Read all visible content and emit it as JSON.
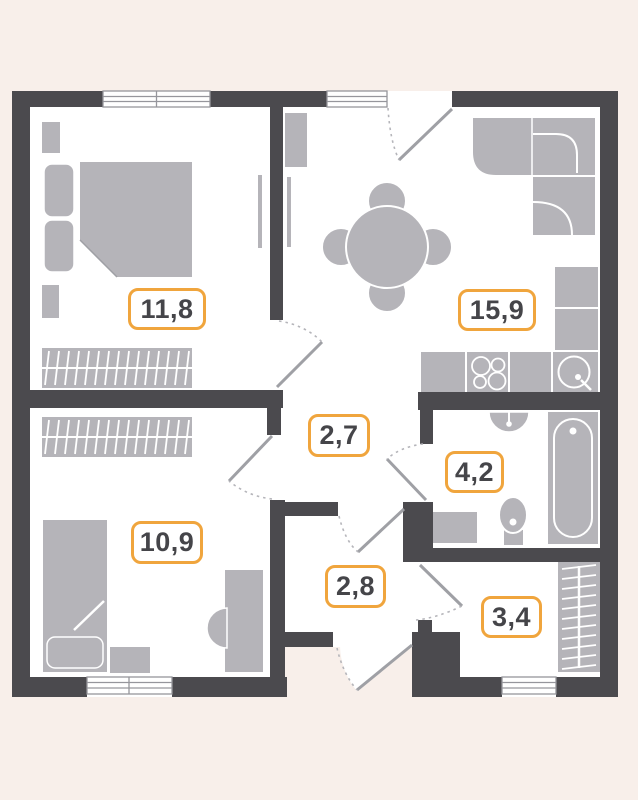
{
  "rooms": {
    "bedroom": {
      "area": "11,8"
    },
    "kitchen_living": {
      "area": "15,9"
    },
    "hall": {
      "area": "2,7"
    },
    "bathroom": {
      "area": "4,2"
    },
    "bedroom_second": {
      "area": "10,9"
    },
    "entry_hall": {
      "area": "2,8"
    },
    "storage": {
      "area": "3,4"
    }
  },
  "colors": {
    "background": "#f8efea",
    "floor": "#ffffff",
    "wall": "#4b4a4e",
    "furniture": "#b5b4b9",
    "window_line": "#96969c",
    "door_leaf": "#9fa0a5",
    "swing_dash": "#b5b5ba",
    "label_border": "#f0a53d",
    "label_text": "#454549"
  }
}
